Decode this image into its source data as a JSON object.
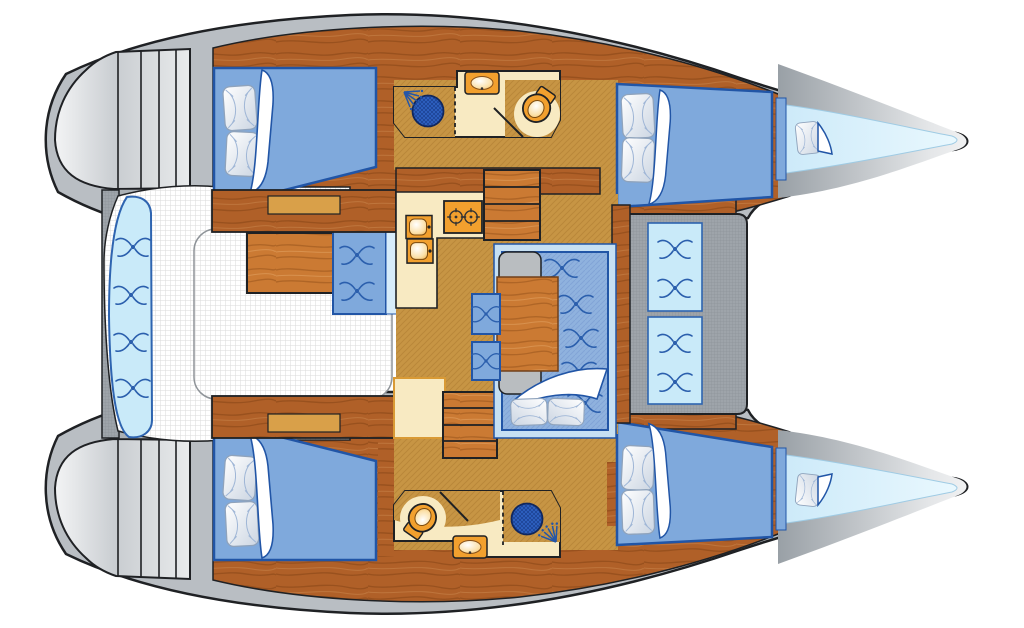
{
  "title": "Catamaran interior layout floor plan",
  "colors": {
    "outline": "#1F2124",
    "hull_gray": "#B9BEC3",
    "deck_gray": "#9EA4AA",
    "wedge_gray": "#ABB1B6",
    "platform_hi": "#F1F2F3",
    "platform_lo": "#C6CACE",
    "wood_dark": "#B06028",
    "wood_light": "#CB7A33",
    "grain": "#7A3E0F",
    "tan": "#C79544",
    "tan_line": "#A97B28",
    "cream": "#F8EAC2",
    "notch": "#D9A049",
    "orange": "#F2A02E",
    "bed_blue": "#7FA9DC",
    "bed_border": "#2155A6",
    "mattress": "#8FB2DE",
    "sofa_platform": "#C6E0F3",
    "light_blue": "#C9EAF9",
    "berth_blue": "#D6EFFB",
    "strip_blue": "#D7ECFA",
    "shower_blue": "#2F63C4",
    "bench_gray": "#B9BDC0",
    "mesh_dot": "#DADADA",
    "white": "#FFFFFF"
  },
  "rooms": {
    "boat": "Catamaran interior layout floor plan",
    "cockpit": "Aft cockpit",
    "cockpit_bench": "Curved cockpit bench",
    "cockpit_table": "Cockpit table",
    "cockpit_seat": "Cockpit seat cushion",
    "salon": "Salon",
    "galley": "Galley with stove and twin sinks",
    "dinette": "Dinette sofa with table",
    "bench_seat": "Bench seat",
    "stools": "Stool cushions",
    "head_port": "Bathroom with shower and WC (port)",
    "head_starboard": "Bathroom with WC and shower (starboard)",
    "cabin_aft_port": "Aft double cabin (port)",
    "cabin_fwd_port": "Forward double cabin (port)",
    "cabin_aft_starboard": "Aft double cabin (starboard)",
    "cabin_fwd_starboard": "Forward double cabin (starboard)",
    "bow_berth_port": "Forepeak berth (port)",
    "bow_berth_starboard": "Forepeak berth (starboard)",
    "foredeck": "Forward cockpit seats",
    "transom_port": "Transom steps (port)",
    "transom_starboard": "Transom steps (starboard)",
    "stairs_port": "Companionway steps (port hull)",
    "stairs_starboard": "Companionway steps (starboard hull)"
  }
}
